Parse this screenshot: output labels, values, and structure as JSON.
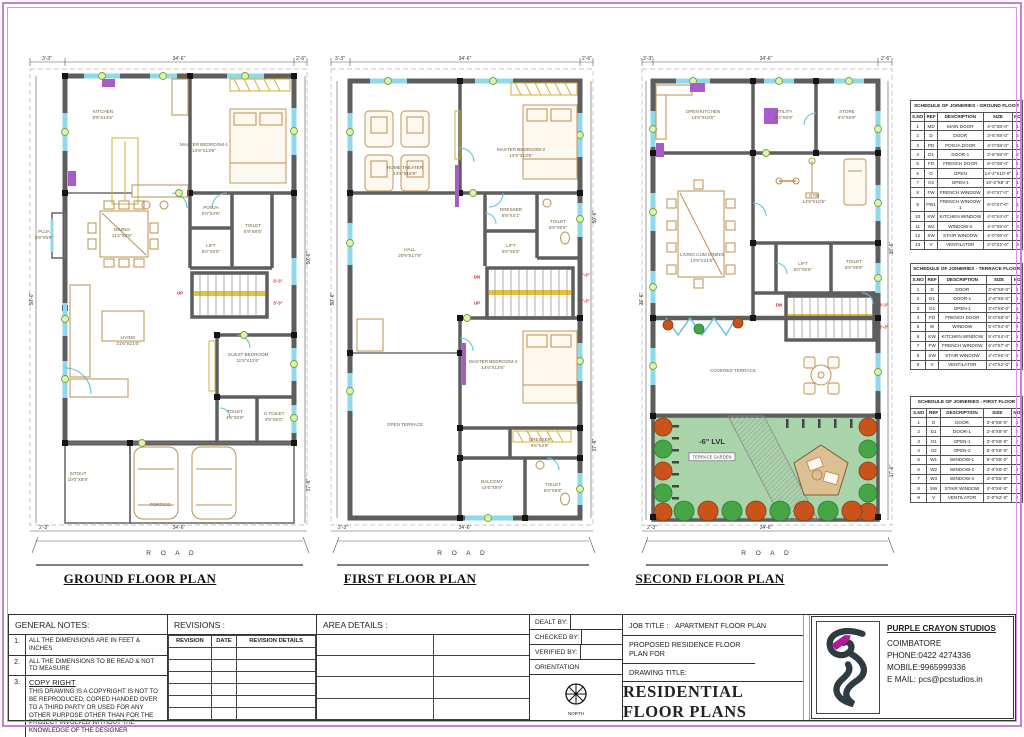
{
  "plans": [
    {
      "title": "GROUND FLOOR PLAN",
      "road": "R O A D",
      "dims": {
        "top_left": "3'-3\"",
        "top_center": "34'-6\"",
        "top_right": "2'-6\"",
        "left": "50'-6\"",
        "right_upper": "50'-6\"",
        "right_lower": "17'-6\"",
        "bottom_left": "2'-3\"",
        "bottom_center": "34'-6\""
      },
      "rooms": [
        {
          "name": "KITCHEN",
          "dim": "8'9\"X13'6\"",
          "x": 81,
          "y": 62
        },
        {
          "name": "MASTER BEDROOM-1",
          "dim": "14'9\"X13'6\"",
          "x": 182,
          "y": 95
        },
        {
          "name": "PUJA",
          "dim": "5'9\"X5'6\"",
          "x": 22,
          "y": 182
        },
        {
          "name": "DINING",
          "dim": "11'2\"X8'6\"",
          "x": 100,
          "y": 180
        },
        {
          "name": "POOJA",
          "dim": "5'0\"X4'6\"",
          "x": 189,
          "y": 158
        },
        {
          "name": "TOILET",
          "dim": "5'9\"X8'6\"",
          "x": 231,
          "y": 176
        },
        {
          "name": "LIFT",
          "dim": "5'0\"X5'5\"",
          "x": 189,
          "y": 196
        },
        {
          "name": "LIVING",
          "dim": "21'6\"X21'6\"",
          "x": 106,
          "y": 288
        },
        {
          "name": "GUEST BEDROOM",
          "dim": "11'6\"X12'6\"",
          "x": 226,
          "y": 305
        },
        {
          "name": "TOILET",
          "dim": "4'6\"X5'6\"",
          "x": 213,
          "y": 362
        },
        {
          "name": "G.TOILET",
          "dim": "4'9\"X5'0\"",
          "x": 252,
          "y": 364
        },
        {
          "name": "SITOUT",
          "dim": "10'0\"X8'9\"",
          "x": 56,
          "y": 424
        },
        {
          "name": "PORTICO",
          "dim": "",
          "x": 138,
          "y": 452
        }
      ],
      "red_labels": [
        {
          "text": "UP",
          "x": 158,
          "y": 240
        },
        {
          "text": "3'-3\"",
          "x": 256,
          "y": 228
        },
        {
          "text": "3'-3\"",
          "x": 256,
          "y": 250
        }
      ]
    },
    {
      "title": "FIRST FLOOR PLAN",
      "road": "R O A D",
      "dims": {
        "top_left": "3'-3\"",
        "top_center": "34'-6\"",
        "top_right": "2'-6\"",
        "left": "50'-6\"",
        "right_upper": "50'-6\"",
        "right_lower": "17'-6\"",
        "bottom_left": "2'-3\"",
        "bottom_center": "34'-6\""
      },
      "rooms": [
        {
          "name": "HOME THEATER",
          "dim": "13'9\"X15'9\"",
          "x": 80,
          "y": 118
        },
        {
          "name": "MASTER BEDROOM-2",
          "dim": "14'9\"X13'6\"",
          "x": 196,
          "y": 100
        },
        {
          "name": "HALL",
          "dim": "20'9\"X17'9\"",
          "x": 85,
          "y": 200
        },
        {
          "name": "DRESSER",
          "dim": "6'9\"X4'1\"",
          "x": 186,
          "y": 160
        },
        {
          "name": "TOILET",
          "dim": "5'9\"X8'6\"",
          "x": 233,
          "y": 172
        },
        {
          "name": "LIFT",
          "dim": "5'0\"X5'5\"",
          "x": 186,
          "y": 196
        },
        {
          "name": "MASTER BEDROOM-3",
          "dim": "14'6\"X13'6\"",
          "x": 168,
          "y": 312
        },
        {
          "name": "OPEN TERRACE",
          "dim": "",
          "x": 80,
          "y": 372
        },
        {
          "name": "DRESSER",
          "dim": "9'6\"X4'6\"",
          "x": 215,
          "y": 390
        },
        {
          "name": "BALCONY",
          "dim": "14'6\"X9'9\"",
          "x": 167,
          "y": 432
        },
        {
          "name": "TOILET",
          "dim": "6'6\"X8'6\"",
          "x": 228,
          "y": 435
        }
      ],
      "red_labels": [
        {
          "text": "DN",
          "x": 152,
          "y": 224
        },
        {
          "text": "UP",
          "x": 152,
          "y": 250
        },
        {
          "text": "3'-3\"",
          "x": 260,
          "y": 222
        },
        {
          "text": "3'-3\"",
          "x": 260,
          "y": 248
        }
      ]
    },
    {
      "title": "SECOND FLOOR PLAN",
      "road": "R O A D",
      "dims": {
        "top_left": "3'-3\"",
        "top_center": "34'-6\"",
        "top_right": "2'-6\"",
        "left": "36'-6\"",
        "right_upper": "36'-6\"",
        "right_lower": "17'-6\"",
        "bottom_left": "2'-3\"",
        "bottom_center": "34'-6\""
      },
      "rooms": [
        {
          "name": "OPEN KITCHEN",
          "dim": "13'9\"X10'6\"",
          "x": 67,
          "y": 62
        },
        {
          "name": "UTILITY",
          "dim": "8'3\"X6'9\"",
          "x": 148,
          "y": 62
        },
        {
          "name": "STORE",
          "dim": "8'3\"X6'9\"",
          "x": 211,
          "y": 62
        },
        {
          "name": "GYM",
          "dim": "14'9\"X10'6\"",
          "x": 178,
          "y": 146
        },
        {
          "name": "LIVING CUM DINING",
          "dim": "13'9\"X21'6\"",
          "x": 66,
          "y": 205
        },
        {
          "name": "LIFT",
          "dim": "5'0\"X5'5\"",
          "x": 167,
          "y": 214
        },
        {
          "name": "TOILET",
          "dim": "5'9\"X5'6\"",
          "x": 218,
          "y": 212
        },
        {
          "name": "COVERED TERRACE",
          "dim": "",
          "x": 97,
          "y": 318
        },
        {
          "name": "-6\" LVL",
          "dim": "",
          "x": 76,
          "y": 389,
          "big": true
        },
        {
          "name": "TERRACE GARDEN",
          "dim": "",
          "x": 76,
          "y": 404,
          "boxed": true
        }
      ],
      "red_labels": [
        {
          "text": "DN",
          "x": 143,
          "y": 252
        },
        {
          "text": "3'-3\"",
          "x": 248,
          "y": 252
        },
        {
          "text": "3'-3\"",
          "x": 248,
          "y": 274
        }
      ]
    }
  ],
  "schedules": [
    {
      "title": "SCHEDULE OF JOINERIES - GROUND FLOOR",
      "headers": [
        "S.NO",
        "REF",
        "DESCRIPTION",
        "SIZE",
        "NO"
      ],
      "rows": [
        [
          "1",
          "MD",
          "MAIN DOOR",
          "4'-0\"X8'-0\"",
          "1"
        ],
        [
          "2",
          "D",
          "DOOR",
          "3'-6\"X8'-0\"",
          "2"
        ],
        [
          "3",
          "PD",
          "POOJA DOOR",
          "4'-0\"X8'-0\"",
          "1"
        ],
        [
          "4",
          "D1",
          "DOOR-1",
          "2'-6\"X8'-0\"",
          "2"
        ],
        [
          "5",
          "FD",
          "FRENCH DOOR",
          "8'-0\"X8'-0\"",
          "1"
        ],
        [
          "6",
          "O",
          "OPEN",
          "14'-4\"X10'-0\"",
          "1"
        ],
        [
          "7",
          "O1",
          "OPEN-1",
          "10'-2\"X8'-3\"",
          "1"
        ],
        [
          "8",
          "FW",
          "FRENCH WINDOW",
          "8'-0\"X7'-0\"",
          "1"
        ],
        [
          "9",
          "FW1",
          "FRENCH WINDOW 1",
          "6'-0\"X7'-0\"",
          "1"
        ],
        [
          "10",
          "KW",
          "KITCHEN WINDOW",
          "4'-0\"X4'-0\"",
          "2"
        ],
        [
          "11",
          "W2",
          "WINDOW-2",
          "4'-0\"X5'-0\"",
          "3"
        ],
        [
          "12",
          "SW",
          "STAIR WINDOW",
          "4'-0\"X6'-0\"",
          "1"
        ],
        [
          "13",
          "V",
          "VENTILATOR",
          "2'-0\"X2'-0\"",
          "3"
        ]
      ]
    },
    {
      "title": "SCHEDULE OF JOINERIES - TERRACE FLOOR",
      "headers": [
        "S.NO",
        "REF",
        "DESCRIPTION",
        "SIZE",
        "NO"
      ],
      "rows": [
        [
          "1",
          "D",
          "DOOR",
          "3'-6\"X8'-0\"",
          "1"
        ],
        [
          "2",
          "D1",
          "DOOR-1",
          "2'-6\"X8'-0\"",
          "1"
        ],
        [
          "3",
          "O1",
          "OPEN-1",
          "3'-0\"X8'-0\"",
          "1"
        ],
        [
          "4",
          "FD",
          "FRENCH DOOR",
          "8'-0\"X8'-0\"",
          "1"
        ],
        [
          "5",
          "W",
          "WINDOW",
          "5'-0\"X4'-0\"",
          "2"
        ],
        [
          "6",
          "KW",
          "KITCHEN WINDOW",
          "5'-0\"X4'-0\"",
          "1"
        ],
        [
          "7",
          "FW",
          "FRENCH WINDOW",
          "6'-0\"X7'-0\"",
          "2"
        ],
        [
          "8",
          "SW",
          "STAIR WINDOW",
          "4'-0\"X6'-0\"",
          "1"
        ],
        [
          "9",
          "V",
          "VENTILATOR",
          "2'-0\"X2'-0\"",
          "1"
        ]
      ]
    },
    {
      "title": "SCHEDULE OF JOINERIES - FIRST FLOOR",
      "headers": [
        "S.NO",
        "REF",
        "DESCRIPTION",
        "SIZE",
        "NO"
      ],
      "rows": [
        [
          "1",
          "D",
          "DOOR",
          "3'-6\"X8'-0\"",
          "4"
        ],
        [
          "2",
          "D1",
          "DOOR-1",
          "2'-6\"X8'-0\"",
          "2"
        ],
        [
          "3",
          "O1",
          "OPEN-1",
          "3'-0\"X8'-0\"",
          "2"
        ],
        [
          "4",
          "O2",
          "OPEN-2",
          "6'-0\"X8'-0\"",
          "1"
        ],
        [
          "5",
          "W1",
          "WINDOW-1",
          "6'-0\"X5'-0\"",
          "1"
        ],
        [
          "6",
          "W2",
          "WINDOW-2",
          "4'-0\"X5'-0\"",
          "4"
        ],
        [
          "7",
          "W3",
          "WINDOW-3",
          "4'-0\"X5'-0\"",
          "1"
        ],
        [
          "8",
          "SW",
          "STAIR WINDOW",
          "4'-0\"X6'-0\"",
          "1"
        ],
        [
          "9",
          "V",
          "VENTILATOR",
          "2'-0\"X2'-0\"",
          "2"
        ]
      ]
    }
  ],
  "titleblock": {
    "general_notes": {
      "title": "GENERAL NOTES:",
      "notes": [
        {
          "no": "1.",
          "text": "ALL THE DIMENSIONS ARE IN FEET & INCHES"
        },
        {
          "no": "2.",
          "text": "ALL THE DIMENSIONS TO BE READ & NOT TO MEASURE"
        },
        {
          "no": "3.",
          "heading": "COPY RIGHT",
          "text": "THIS DRAWING IS A COPYRIGHT IS NOT TO BE REPRODUCED, COPIED HANDED OVER TO A THIRD PARTY OR USED FOR ANY OTHER PURPOSE OTHER THAN FOR THE PROJECT INVOLVED WITHOUT THE KNOWLEDGE OF THE DESIGNER"
        }
      ]
    },
    "revisions": {
      "title": "REVISIONS :",
      "headers": [
        "REVISION",
        "DATE",
        "REVISION DETAILS"
      ],
      "empty_rows": 6
    },
    "area_details": {
      "title": "AREA DETAILS :",
      "cols": 2,
      "empty_rows": 4
    },
    "signoff": {
      "dealt": "DEALT BY:",
      "checked": "CHECKED BY:",
      "verified": "VERIFIED BY:",
      "orientation": "ORIENTATION",
      "compass_label": "NORTH"
    },
    "job": {
      "job_title_label": "JOB TITLE :",
      "job_title": "APARTMENT FLOOR PLAN",
      "proposed": "PROPOSED RESIDENCE FLOOR PLAN FOR",
      "drawing_title_label": "DRAWING TITLE:",
      "drawing_title": "RESIDENTIAL FLOOR PLANS"
    },
    "company": {
      "name": "PURPLE CRAYON STUDIOS",
      "city": "COIMBATORE",
      "phone": "PHONE:0422 4274336",
      "mobile": "MOBILE:9965999336",
      "email": "E MAIL: pcs@pcstudios.in"
    }
  }
}
